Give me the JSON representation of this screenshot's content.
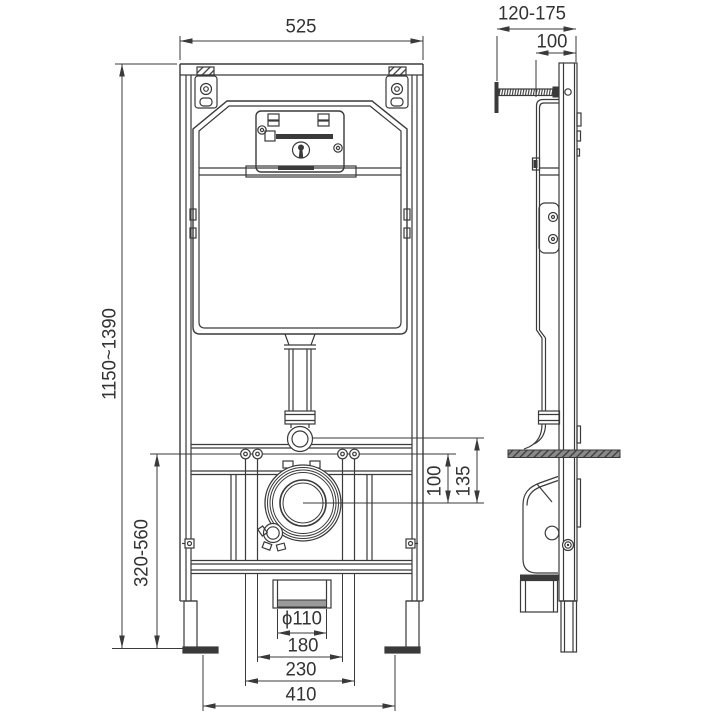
{
  "dimensions": {
    "top_width": "525",
    "height_range": "1150~1390",
    "lower_height_range": "320-560",
    "bolts_to_outlet_offset": "100",
    "flush_to_outlet_offset": "135",
    "drain_diameter": "ϕ110",
    "inner_bolt_spacing": "180",
    "outer_bolt_spacing": "230",
    "feet_spacing": "410",
    "side_depth_range": "120-175",
    "side_frame_depth": "100"
  },
  "style": {
    "line_color": "#3a3a3a",
    "background": "#ffffff"
  }
}
